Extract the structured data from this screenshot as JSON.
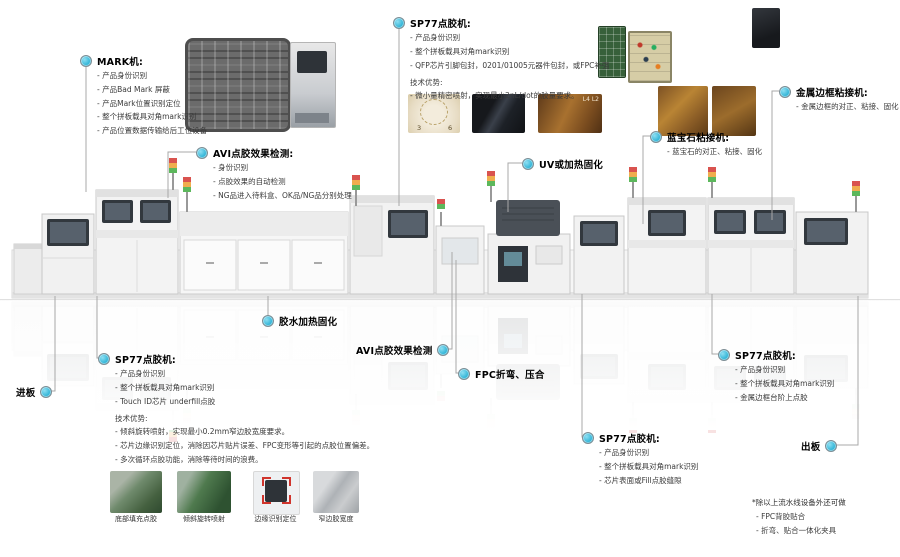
{
  "accent": {
    "dot_color": "#27b0d4",
    "leader_line_color": "#a8a8a8"
  },
  "callouts": {
    "mark": {
      "title": "MARK机:",
      "items": [
        "产品身份识别",
        "产品Bad Mark 屏蔽",
        "产品Mark位置识别定位",
        "整个拼板载具对角mark识别",
        "产品位置数据传输给后工位设备"
      ]
    },
    "sp77_top": {
      "title": "SP77点胶机:",
      "items": [
        "产品身份识别",
        "整个拼板载具对角mark识别",
        "QFP芯片引脚包封，0201/01005元器件包封，或FPC补强"
      ],
      "tech_title": "技术优势:",
      "tech_items": [
        "微小量精密喷射，实现最小2nL/dot的胶量要求。"
      ]
    },
    "avi_top": {
      "title": "AVI点胶效果检测:",
      "items": [
        "身份识别",
        "点胶效果的自动检测",
        "NG品进入待料盒、OK品/NG品分别处理"
      ]
    },
    "uv": {
      "title": "UV或加热固化"
    },
    "sapphire": {
      "title": "蓝宝石粘接机:",
      "items": [
        "蓝宝石的对正、粘接、固化"
      ]
    },
    "metal_frame": {
      "title": "金属边框粘接机:",
      "items": [
        "金属边框的对正、粘接、固化"
      ]
    },
    "in_board": {
      "title": "进板"
    },
    "sp77_left": {
      "title": "SP77点胶机:",
      "items": [
        "产品身份识别",
        "整个拼板载具对角mark识别",
        "Touch ID芯片 underfill点胶"
      ],
      "tech_title": "技术优势:",
      "tech_items": [
        "倾斜旋转喷射，实现最小0.2mm窄边胶宽度要求。",
        "芯片边缘识别定位，消除因芯片贴片误差、FPC变形等引起的点胶位置偏差。",
        "多次循环点胶功能，消除等待时间的浪费。"
      ]
    },
    "glue_cure": {
      "title": "胶水加热固化"
    },
    "avi_bottom": {
      "title": "AVI点胶效果检测"
    },
    "fpc": {
      "title": "FPC折弯、压合"
    },
    "sp77_mid": {
      "title": "SP77点胶机:",
      "items": [
        "产品身份识别",
        "整个拼板载具对角mark识别",
        "芯片表面或Fill点胶缝隙"
      ]
    },
    "sp77_right": {
      "title": "SP77点胶机:",
      "items": [
        "产品身份识别",
        "整个拼板载具对角mark识别",
        "金属边框台阶上点胶"
      ]
    },
    "out_board": {
      "title": "出板"
    }
  },
  "photos": {
    "beige_marks": [
      "3",
      "6"
    ],
    "gold_label": "L4 L2"
  },
  "gallery": {
    "captions": [
      "底部填充点胶",
      "倾斜旋转喷射",
      "边缘识别定位",
      "窄边胶宽度"
    ]
  },
  "footnote": {
    "title": "*除以上流水线设备外还可做",
    "items": [
      "FPC背胶贴合",
      "折弯、贴合一体化夹具"
    ]
  }
}
